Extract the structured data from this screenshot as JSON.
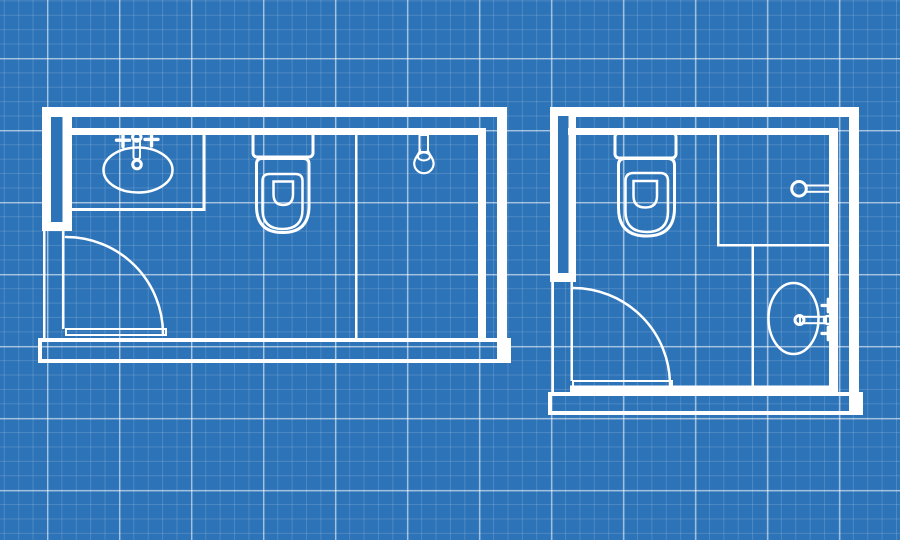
{
  "scene": {
    "type": "blueprint-floor-plan",
    "description": "Two bathroom floor plans drawn as white outline line-work on a blue engineering-grid blueprint background. No text is rendered in the image.",
    "plans": [
      {
        "id": "left-bathroom",
        "shape": "wide-rectangle",
        "fixtures": [
          "vanity-counter",
          "oval-sink-with-faucet-and-two-cross-handles",
          "toilet-with-tank",
          "shower-partition-line",
          "hanging-shower-head",
          "inward-swing-door-bottom-left"
        ]
      },
      {
        "id": "right-bathroom",
        "shape": "near-square",
        "fixtures": [
          "toilet-with-tank",
          "wall-mounted-towel-bar",
          "partition-walls-l-shaped",
          "oval-basin-with-wall-faucet-and-two-cross-handles",
          "inward-swing-door-bottom-left"
        ]
      }
    ]
  },
  "colors": {
    "background": "#2d73b8",
    "grid_minor": "rgba(255,255,255,0.15)",
    "grid_major": "rgba(255,255,255,0.5)",
    "line": "#ffffff"
  },
  "grid": {
    "minor_spacing_px": 14.4,
    "major_spacing_px": 72,
    "major_offset_x_px": 47,
    "major_offset_y_px": 58
  },
  "canvas": {
    "width_px": 900,
    "height_px": 540
  }
}
